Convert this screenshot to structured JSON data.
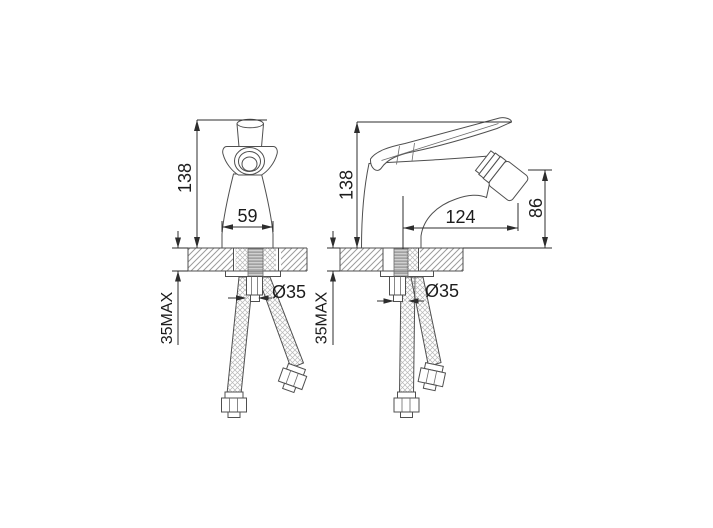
{
  "front_view": {
    "height": "138",
    "base_width": "59",
    "hole_diameter": "Ø35",
    "max_deck_thickness": "35MAX"
  },
  "side_view": {
    "height": "138",
    "spout_reach": "124",
    "spout_height": "86",
    "hole_diameter": "Ø35",
    "max_deck_thickness": "35MAX"
  },
  "colors": {
    "background": "#ffffff",
    "outline": "#4f4f4f",
    "dimension_line": "#2d2d2d",
    "label_text": "#1c1c1c",
    "deck_hatch": "#9b9b9b",
    "braid_hatch": "#b5b5b5",
    "thread_hatch": "#828282"
  }
}
